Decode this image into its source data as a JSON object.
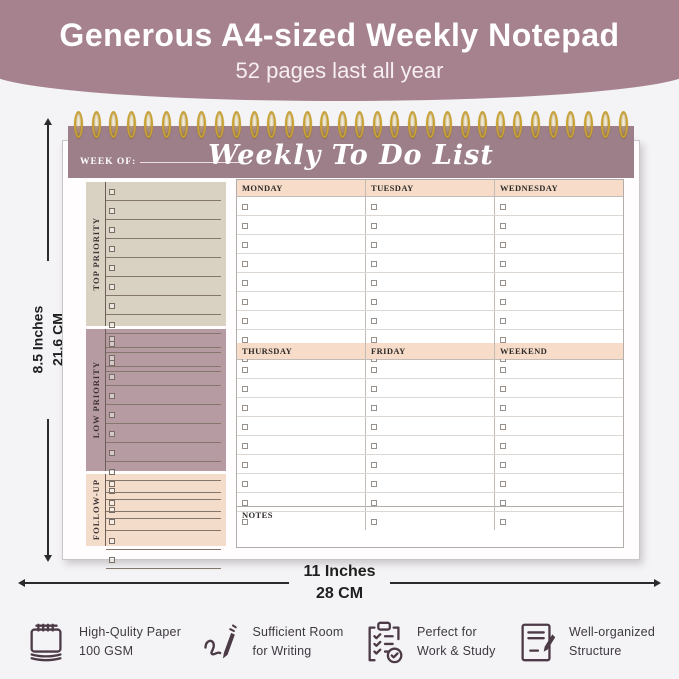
{
  "banner": {
    "title": "Generous A4-sized Weekly Notepad",
    "subtitle": "52 pages last all year"
  },
  "notepad": {
    "week_of_label": "WEEK OF:",
    "title": "Weekly To Do List",
    "ring_count": 32,
    "priority_sections": [
      {
        "label": "TOP PRIORITY",
        "rows": 10,
        "bg": "#d9d1c2",
        "height": 144
      },
      {
        "label": "LOW PRIORITY",
        "rows": 10,
        "bg": "#b79ba3",
        "height": 142
      },
      {
        "label": "FOLLOW-UP",
        "rows": 5,
        "bg": "#f4dcca",
        "height": 72
      }
    ],
    "day_groups": [
      {
        "days": [
          "MONDAY",
          "TUESDAY",
          "WEDNESDAY"
        ],
        "rows": 9
      },
      {
        "days": [
          "THURSDAY",
          "FRIDAY",
          "WEEKEND"
        ],
        "rows": 9
      }
    ],
    "notes_label": "NOTES"
  },
  "dimensions": {
    "height_line1": "8.5 Inches",
    "height_line2": "21.6 CM",
    "width_line1": "11 Inches",
    "width_line2": "28 CM"
  },
  "features": [
    {
      "icon": "spiral-notepad-icon",
      "line1": "High-Qulity Paper",
      "line2": "100 GSM"
    },
    {
      "icon": "pen-scribble-icon",
      "line1": "Sufficient Room",
      "line2": "for Writing"
    },
    {
      "icon": "clipboard-check-icon",
      "line1": "Perfect for",
      "line2": "Work & Study"
    },
    {
      "icon": "document-pen-icon",
      "line1": "Well-organized",
      "line2": "Structure"
    }
  ],
  "colors": {
    "banner_bg": "#a5828e",
    "band_bg": "#9d7f8a",
    "page_bg": "#fffdfd",
    "day_header_bg": "#f6dcc9",
    "ring_gold": "#c9a133",
    "icon_stroke": "#4c3a46"
  }
}
